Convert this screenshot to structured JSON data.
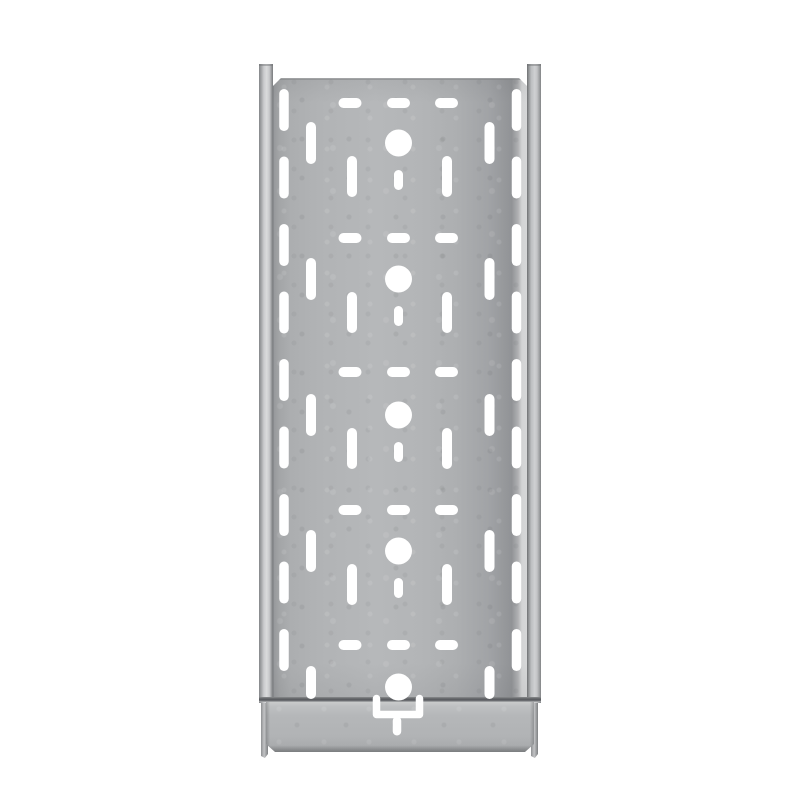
{
  "scene": {
    "subject": "galvanized-perforated-cable-tray",
    "view": "top-down-product-photo",
    "background_color": "#ffffff"
  },
  "palette": {
    "background": "#ffffff",
    "hole": "#ffffff",
    "plate_base": "#b3b5b7",
    "plate_shadow": "#919396",
    "rail_highlight": "#d9dadb",
    "rail_dark_edge": "#6f7173",
    "seam": "#595b5e",
    "coupler_top_highlight": "#cccdce",
    "coupler_bottom_edge": "#7b7d7f"
  },
  "geometry": {
    "canvas": {
      "x": 0,
      "y": 0,
      "w": 800,
      "h": 800
    },
    "plate": {
      "x": 273,
      "y": 78,
      "w": 254,
      "h": 622
    },
    "rail_left": {
      "x": 259,
      "y": 64,
      "w": 14,
      "h": 639
    },
    "rail_right": {
      "x": 527,
      "y": 64,
      "w": 14,
      "h": 639
    },
    "leg_left": {
      "x": 261,
      "y": 700,
      "w": 7,
      "h": 58
    },
    "leg_right": {
      "x": 531,
      "y": 700,
      "w": 7,
      "h": 58
    },
    "coupler": {
      "x": 266,
      "y": 701,
      "w": 268,
      "h": 51
    },
    "seam": {
      "x": 259,
      "y": 697,
      "w": 282,
      "h": 5
    }
  },
  "pattern": {
    "center_x": 398.5,
    "units": [
      {
        "dash_y": 103,
        "circle_y": 143,
        "full": true
      },
      {
        "dash_y": 238,
        "circle_y": 279,
        "full": true
      },
      {
        "dash_y": 372,
        "circle_y": 415,
        "full": true
      },
      {
        "dash_y": 510,
        "circle_y": 551,
        "full": true
      },
      {
        "dash_y": 645,
        "circle_y": 687,
        "full": false
      }
    ],
    "dash": {
      "centers_x": [
        350,
        398.5,
        446.5
      ],
      "w": 23,
      "h": 10
    },
    "circle_r": 13.5,
    "short_slot": {
      "w": 9,
      "offset_top": 27,
      "len": 20
    },
    "mid_slots": {
      "centers_x": [
        352,
        447
      ],
      "w": 10,
      "offset_top": 13,
      "len": 41
    },
    "edge_slots_outer": {
      "centers_x": [
        284,
        516.5
      ],
      "w": 9.5,
      "len": 42,
      "start_cy": 110,
      "pitch": 67.5,
      "count": 9
    },
    "edge_slots_inner": {
      "centers_x": [
        311,
        489.5
      ],
      "w": 10,
      "len": 42
    },
    "inner_truncated_end_y": 699,
    "connector": {
      "u_left_x": 376.5,
      "u_right_x": 419.5,
      "u_top_y": 698.5,
      "u_bar_y": 714.5,
      "u_stroke": 7.5,
      "slot": {
        "cx": 397,
        "w": 8.5,
        "y1": 716.5,
        "y2": 735.5
      }
    }
  }
}
